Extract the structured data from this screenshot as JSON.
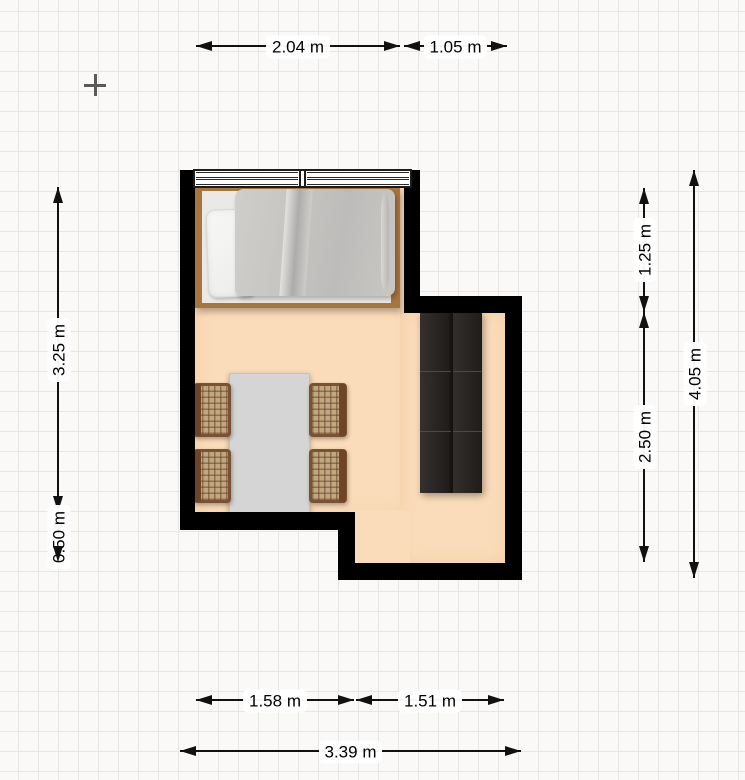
{
  "scene": {
    "type": "floor-plan-editor-canvas",
    "units": "m",
    "grid_size_px": 20,
    "scale_px_per_m": 100
  },
  "colors": {
    "canvas_bg": "#faf9f7",
    "grid_line": "#e8e6e2",
    "wall": "#000000",
    "floor": "#fbdcba",
    "window_frame": "#1c1c1c",
    "bed_frame_wood": "#a7753e",
    "mattress": "#ebe9e5",
    "pillow": "#f4f4f2",
    "blanket": "#c6c5c2",
    "table_top": "#d5d5d5",
    "chair_wood": "#7b5133",
    "chair_cane": "#c2a67e",
    "wardrobe": "#272320",
    "dimension_line": "#111111",
    "crosshair": "#5a5a5a"
  },
  "measurements": {
    "window_width": "2.04 m",
    "top_right_inset": "1.05 m",
    "left_upper": "3.25 m",
    "left_lower": "0.50 m",
    "right_upper_inset": "1.25 m",
    "right_lower_inset": "2.50 m",
    "right_total": "4.05 m",
    "bottom_left_inner": "1.58 m",
    "bottom_right_inner": "1.51 m",
    "bottom_total": "3.39 m"
  },
  "furniture": {
    "bed": "single bed with pillow and grey blanket",
    "table": "rectangular dining table",
    "chairs_count": 4,
    "wardrobe": "dark two-door wardrobe",
    "window": "double-pane window on top wall"
  }
}
